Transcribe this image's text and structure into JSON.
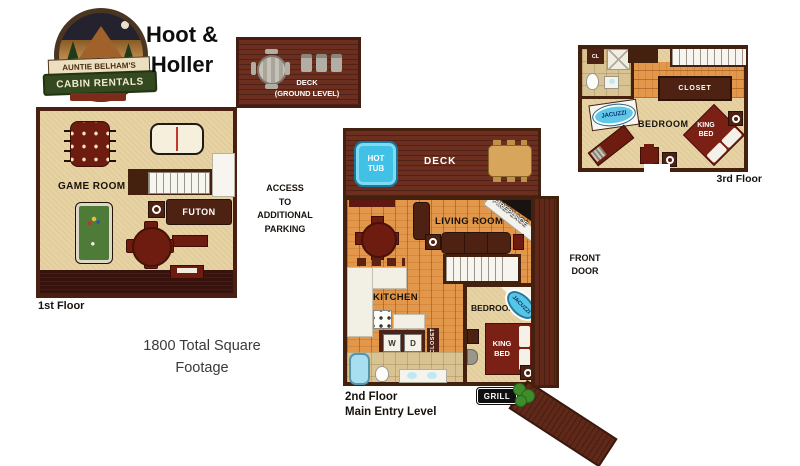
{
  "logo": {
    "brand_line1": "AUNTIE BELHAM'S",
    "brand_line2": "CABIN RENTALS"
  },
  "header": {
    "cabin_name": "Hoot &\nHoller"
  },
  "notes": {
    "access_parking": "ACCESS\nTO\nADDITIONAL\nPARKING",
    "total_square_footage": "1800 Total Square\nFootage"
  },
  "ground_deck": {
    "label": "DECK\n(GROUND LEVEL)"
  },
  "floor1": {
    "caption": "1st Floor",
    "game_room_label": "GAME ROOM",
    "futon_label": "FUTON"
  },
  "floor2": {
    "caption": "2nd Floor\nMain Entry Level",
    "deck_label": "DECK",
    "hot_tub_label": "HOT\nTUB",
    "living_room_label": "LIVING ROOM",
    "fireplace_label": "FIREPLACE",
    "kitchen_label": "KITCHEN",
    "bedroom_label": "BEDROOM",
    "king_bed_label": "KING\nBED",
    "jacuzzi_label": "JACUZZI",
    "closet_label": "CLOSET",
    "washer_label": "W",
    "dryer_label": "D",
    "front_door_label": "FRONT\nDOOR",
    "grill_label": "GRILL"
  },
  "floor3": {
    "caption": "3rd Floor",
    "closet_small_label": "CL",
    "closet_label": "CLOSET",
    "jacuzzi_label": "JACUZZI",
    "bedroom_label": "BEDROOM",
    "king_bed_label": "KING\nBED"
  },
  "colors": {
    "floor_tan": "#e6d2a2",
    "wall_brown": "#44200f",
    "deck_brown": "#6b2e1f",
    "porch_dark": "#38120c",
    "wood_orange": "#e2974a",
    "hot_tub_blue": "#41c1e6",
    "jacuzzi_blue": "#55c6e8",
    "bed_red": "#7a2015",
    "pool_felt_green": "#4e7c38",
    "logo_green": "#34491f",
    "bush_green": "#3e8c2b"
  }
}
